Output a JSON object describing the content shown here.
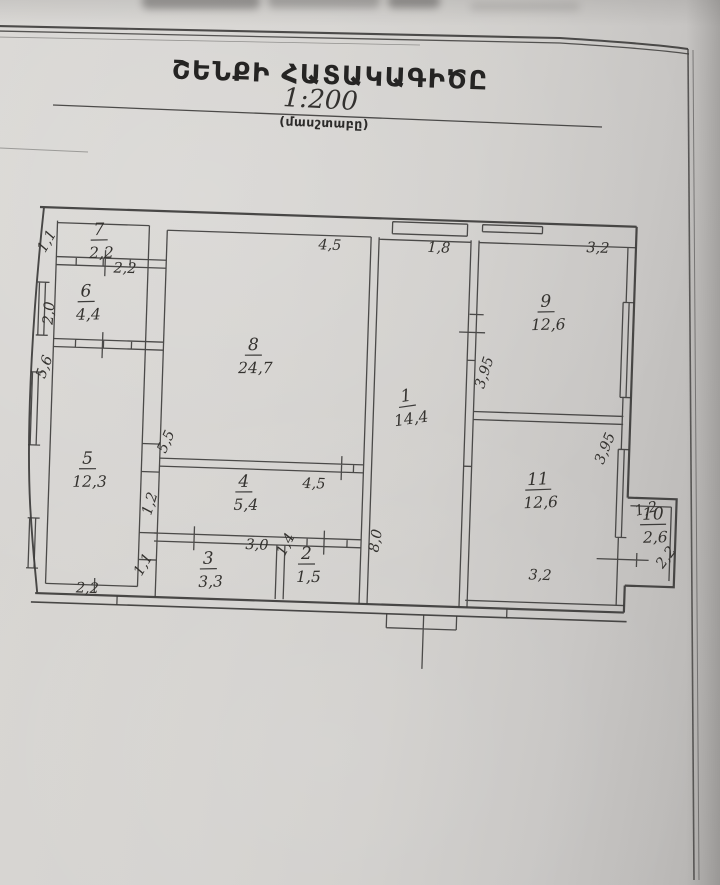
{
  "header": {
    "title": "ՇԵՆՔԻ ՀԱՏԱԿԱԳԻԾԸ",
    "scale_value": "1:200",
    "scale_caption": "(մասշտաբը)"
  },
  "plan": {
    "rooms": [
      {
        "number": "7",
        "area": "2,2",
        "x": 100,
        "y": 233,
        "rot": -3
      },
      {
        "number": "6",
        "area": "4,4",
        "x": 89,
        "y": 295,
        "rot": -3
      },
      {
        "number": "5",
        "area": "12,3",
        "x": 96,
        "y": 462,
        "rot": -2
      },
      {
        "number": "8",
        "area": "24,7",
        "x": 258,
        "y": 343,
        "rot": -2
      },
      {
        "number": "4",
        "area": "5,4",
        "x": 253,
        "y": 480,
        "rot": -2
      },
      {
        "number": "3",
        "area": "3,3",
        "x": 220,
        "y": 558,
        "rot": -3
      },
      {
        "number": "2",
        "area": "1,5",
        "x": 318,
        "y": 550,
        "rot": -2
      },
      {
        "number": "1",
        "area": "14,4",
        "x": 413,
        "y": 389,
        "rot": -10
      },
      {
        "number": "9",
        "area": "12,6",
        "x": 549,
        "y": 290,
        "rot": -3
      },
      {
        "number": "11",
        "area": "12,6",
        "x": 547,
        "y": 468,
        "rot": -4
      },
      {
        "number": "10",
        "area": "2,6",
        "x": 663,
        "y": 499,
        "rot": -3
      }
    ],
    "dimensions": [
      {
        "text": "2,2",
        "x": 127,
        "y": 270,
        "rot": 0
      },
      {
        "text": "1,1",
        "x": 52,
        "y": 243,
        "rot": -62
      },
      {
        "text": "2,0",
        "x": 57,
        "y": 313,
        "rot": -87
      },
      {
        "text": "5,6",
        "x": 54,
        "y": 368,
        "rot": -72
      },
      {
        "text": "2,2",
        "x": 100,
        "y": 591,
        "rot": 0
      },
      {
        "text": "4,5",
        "x": 331,
        "y": 240,
        "rot": 0
      },
      {
        "text": "5,5",
        "x": 178,
        "y": 439,
        "rot": -68
      },
      {
        "text": "4,5",
        "x": 323,
        "y": 479,
        "rot": 0
      },
      {
        "text": "1,2",
        "x": 164,
        "y": 501,
        "rot": -75
      },
      {
        "text": "1,1",
        "x": 159,
        "y": 563,
        "rot": -62
      },
      {
        "text": "3,0",
        "x": 268,
        "y": 542,
        "rot": 0
      },
      {
        "text": "1,4",
        "x": 301,
        "y": 538,
        "rot": -65
      },
      {
        "text": "1,8",
        "x": 440,
        "y": 239,
        "rot": 0
      },
      {
        "text": "8,0",
        "x": 391,
        "y": 530,
        "rot": -82
      },
      {
        "text": "3,2",
        "x": 599,
        "y": 234,
        "rot": 0
      },
      {
        "text": "3,95",
        "x": 494,
        "y": 359,
        "rot": -74
      },
      {
        "text": "3,95",
        "x": 617,
        "y": 431,
        "rot": -70
      },
      {
        "text": "3,2",
        "x": 552,
        "y": 563,
        "rot": 0
      },
      {
        "text": "1,2",
        "x": 657,
        "y": 493,
        "rot": -15
      },
      {
        "text": "2,2",
        "x": 681,
        "y": 539,
        "rot": -55
      }
    ]
  }
}
